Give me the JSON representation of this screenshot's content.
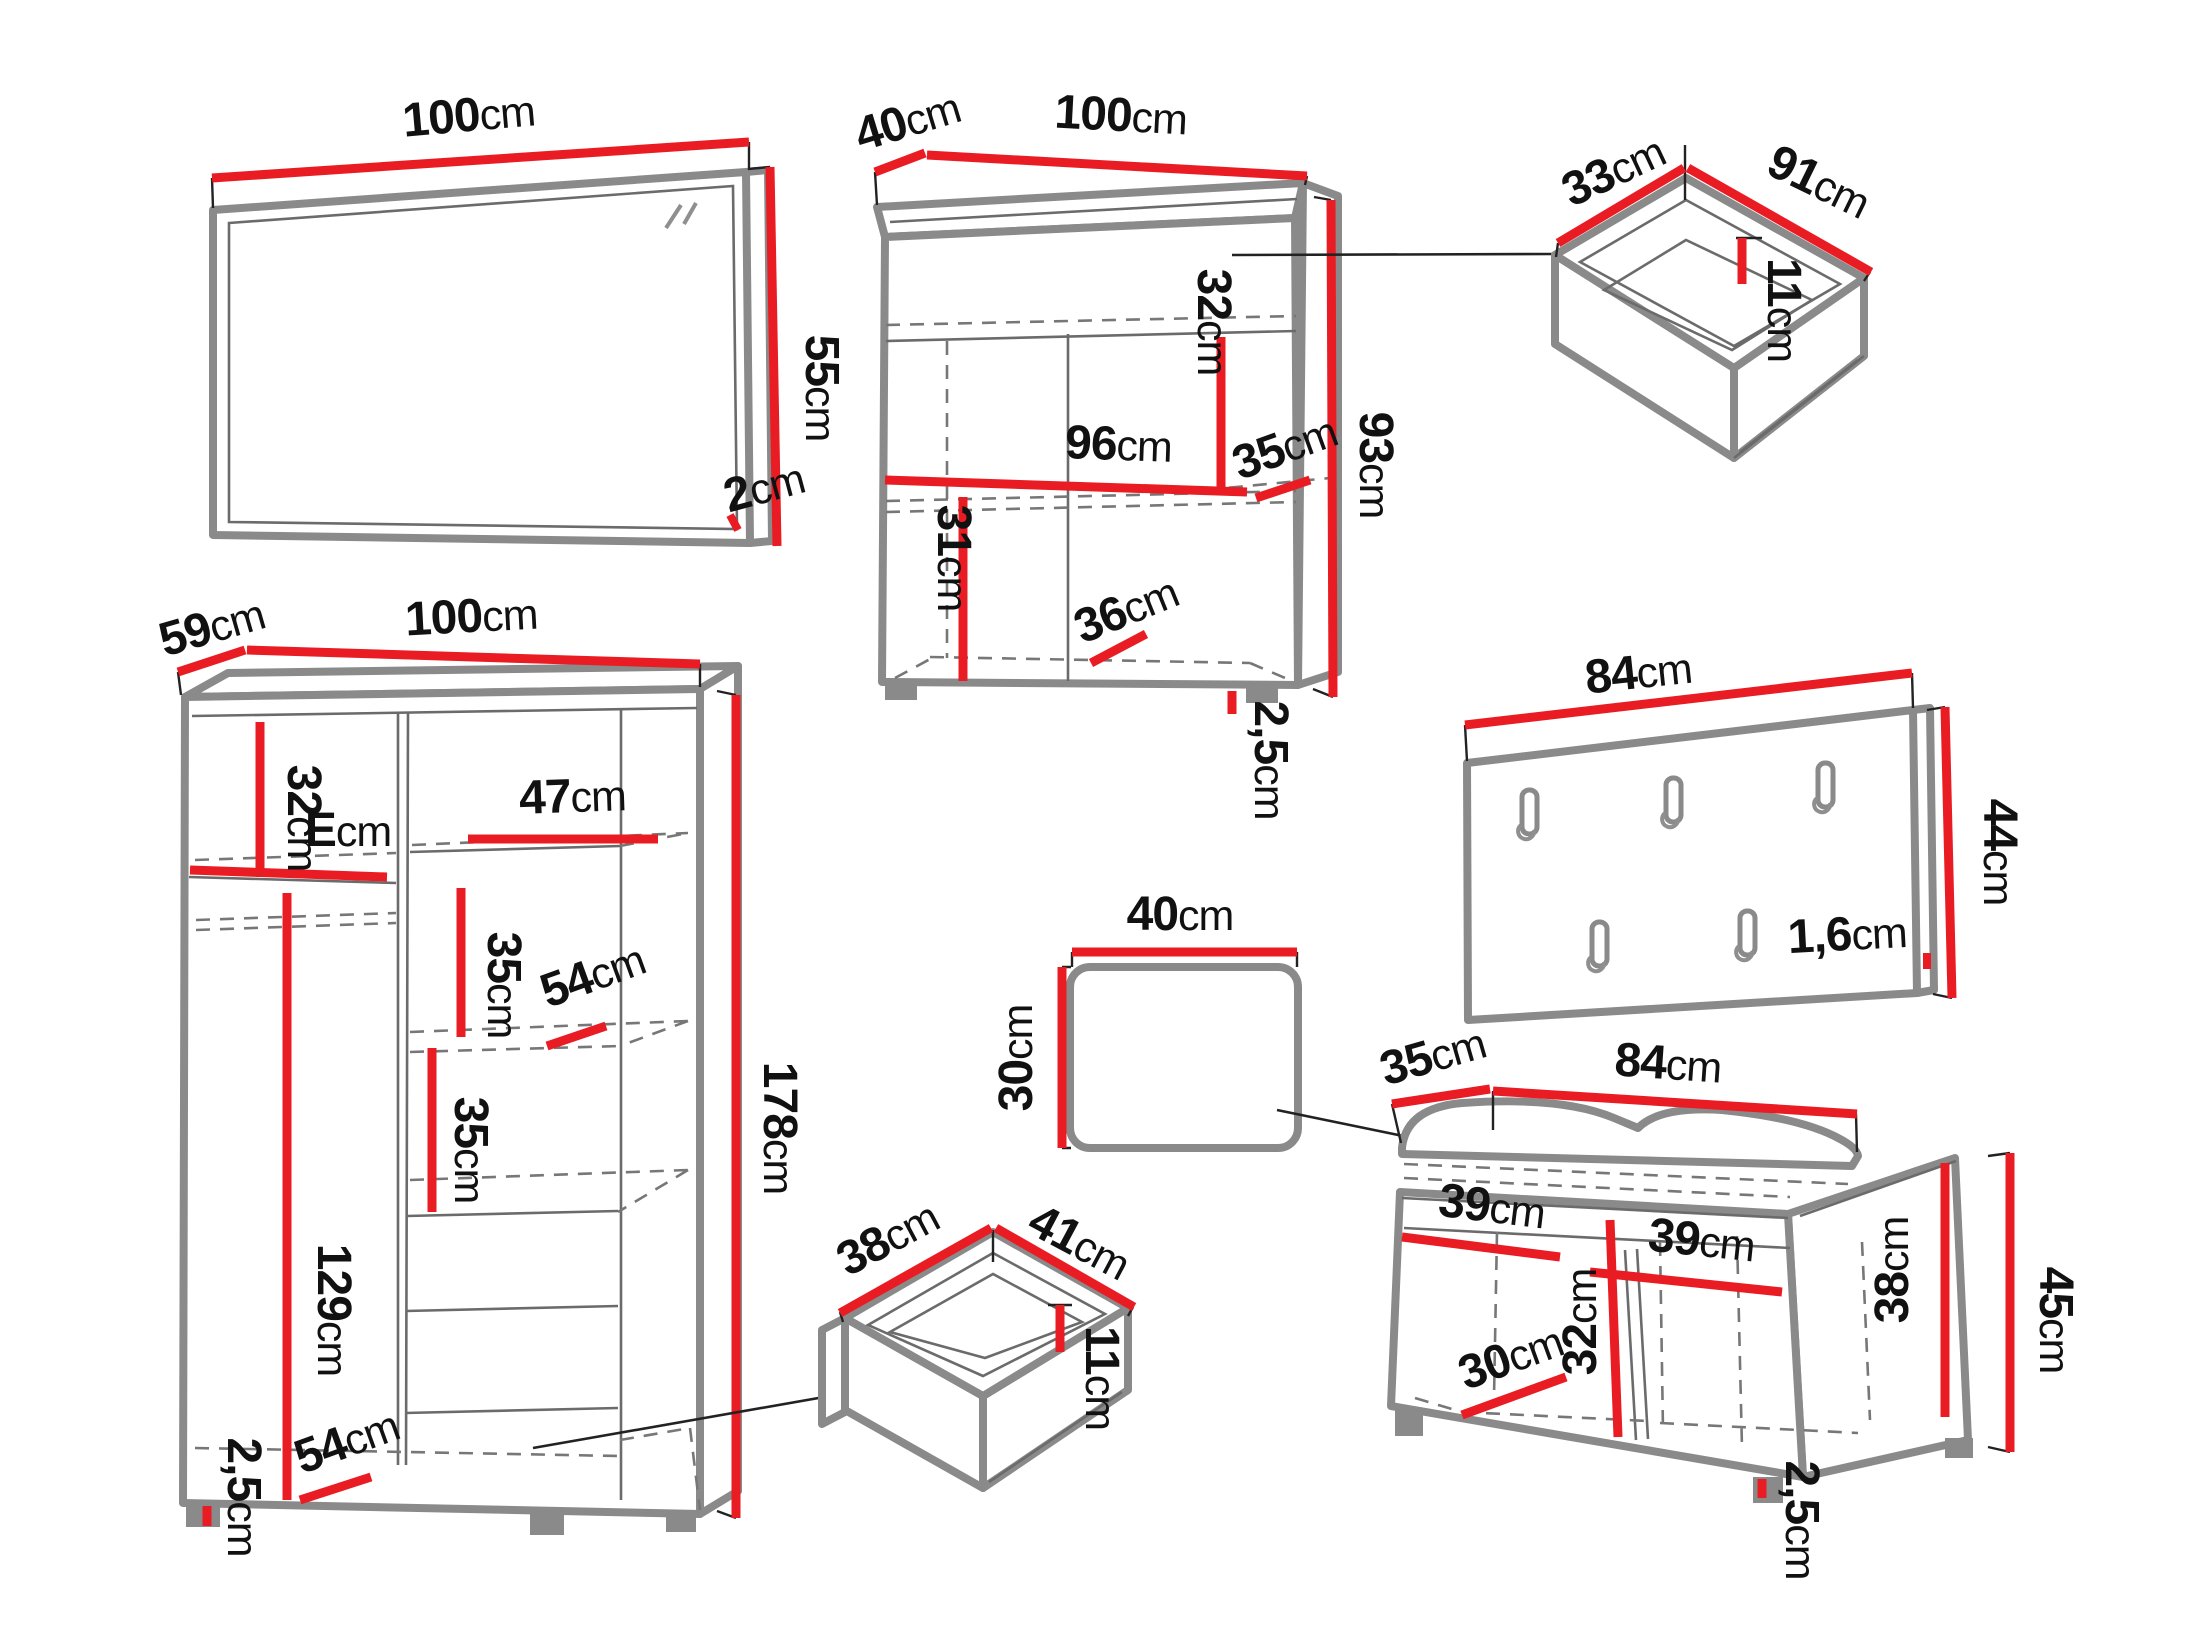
{
  "figure": {
    "kind": "furniture dimension diagram",
    "pieces_count": 8
  },
  "unit": "cm",
  "colors": {
    "dimension_red": "#ea1c23",
    "furniture_gray": "#8a8a8a",
    "text_black": "#111111",
    "background": "#ffffff"
  },
  "pieces": {
    "mirror": {
      "name": "wall mirror",
      "width": "100",
      "height": "55",
      "depth": "2"
    },
    "sideboard": {
      "name": "sideboard cabinet",
      "depth": "40",
      "width": "100",
      "inner_width": "96",
      "upper_inner_height": "32",
      "inner_depth": "35",
      "height": "93",
      "lower_inner_height": "31",
      "bottom_inner_depth": "36",
      "plinth": "2,5"
    },
    "drawer_top": {
      "name": "pull-out drawer",
      "depth": "33",
      "width": "91",
      "inner_height": "11"
    },
    "wardrobe": {
      "name": "wardrobe",
      "depth": "59",
      "width": "100",
      "top_inner_height": "32",
      "top_shelf_width": "E",
      "right_shelf_width": "47",
      "shelf_gap_upper": "35",
      "shelf_depth": "54",
      "shelf_gap_lower": "35",
      "hanging_height": "129",
      "height": "178",
      "bottom_depth": "54",
      "plinth": "2,5"
    },
    "coat_rack": {
      "name": "coat rack panel",
      "width": "84",
      "height": "44",
      "thickness": "1,6",
      "hooks_count": 5
    },
    "stool": {
      "name": "stool seat",
      "width": "40",
      "depth": "30"
    },
    "drawer_bottom": {
      "name": "pull-out drawer",
      "depth": "38",
      "width": "41",
      "inner_height": "11"
    },
    "bench": {
      "name": "shoe bench",
      "depth": "35",
      "width": "84",
      "left_inner_width": "39",
      "right_inner_width": "39",
      "inner_height": "32",
      "right_inner_height": "38",
      "bottom_inner_depth": "30",
      "height": "45",
      "plinth": "2,5"
    }
  }
}
